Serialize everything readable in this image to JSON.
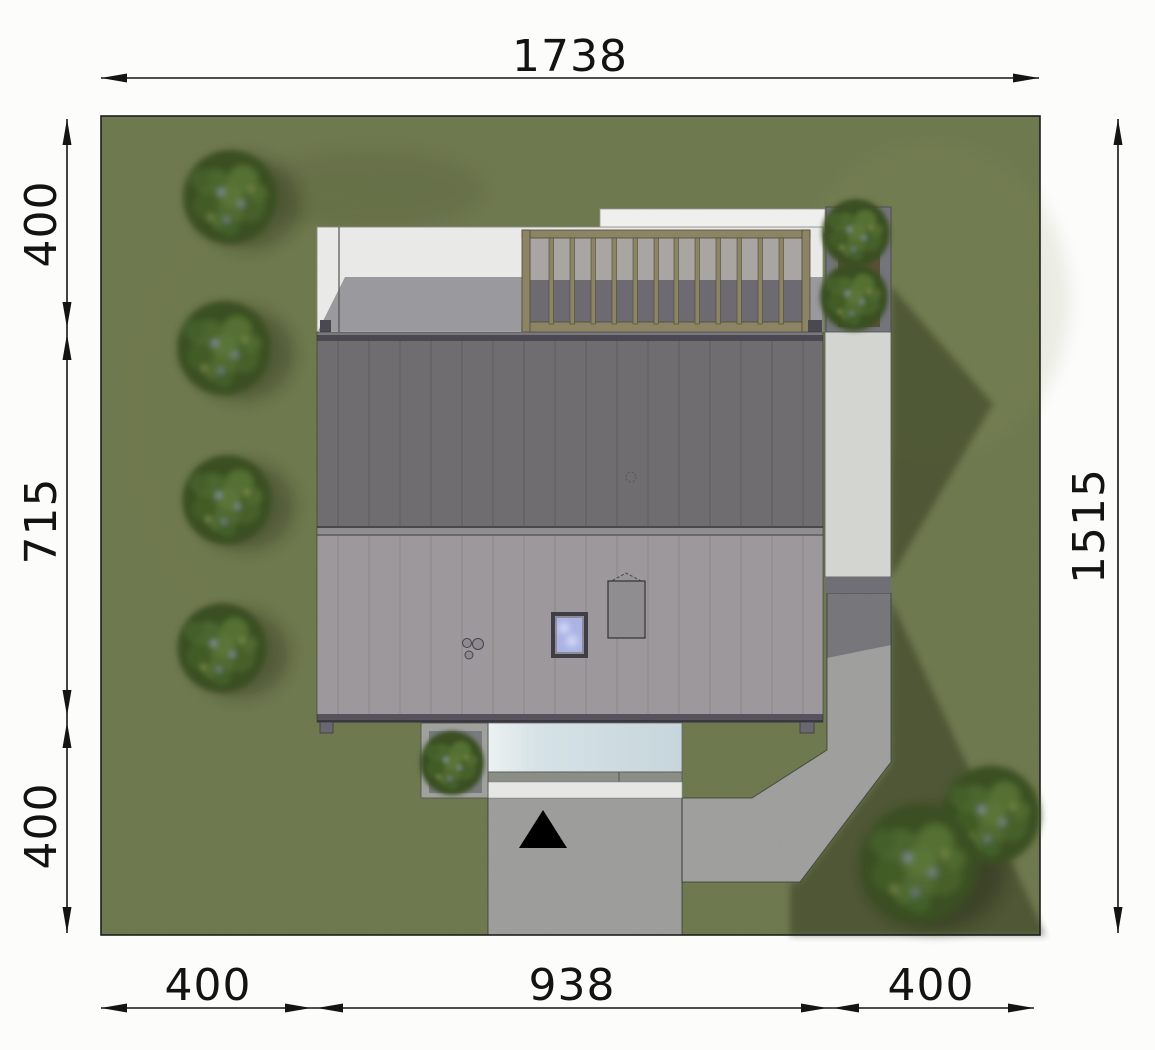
{
  "drawing": {
    "title_visible_text": null,
    "dimensions": {
      "top": "1738",
      "right": "1515",
      "left": {
        "upper": "400",
        "middle": "715",
        "lower": "400"
      },
      "bottom": {
        "left": "400",
        "center": "938",
        "right": "400"
      }
    },
    "icons": {
      "entrance_marker": "▲"
    },
    "colors": {
      "sheet": "#fcfcfb",
      "grass": "#78864c",
      "grass_shadow": "#5a683a",
      "roof_upper": "#6f6d6f",
      "roof_lower": "#9c989b",
      "ridge": "#908e90",
      "terrace": "#e9e9e7",
      "terrace_shadow": "#7b7680",
      "pergola_wood": "#8b8465",
      "east_patio": "#d3d5d1",
      "paving": "#b6b6b4",
      "canopy_glass": "#cfdde2",
      "skylight_glass": "#aab3e4",
      "tree_foliage": "#48612c",
      "dimension_lines": "#141414"
    }
  }
}
